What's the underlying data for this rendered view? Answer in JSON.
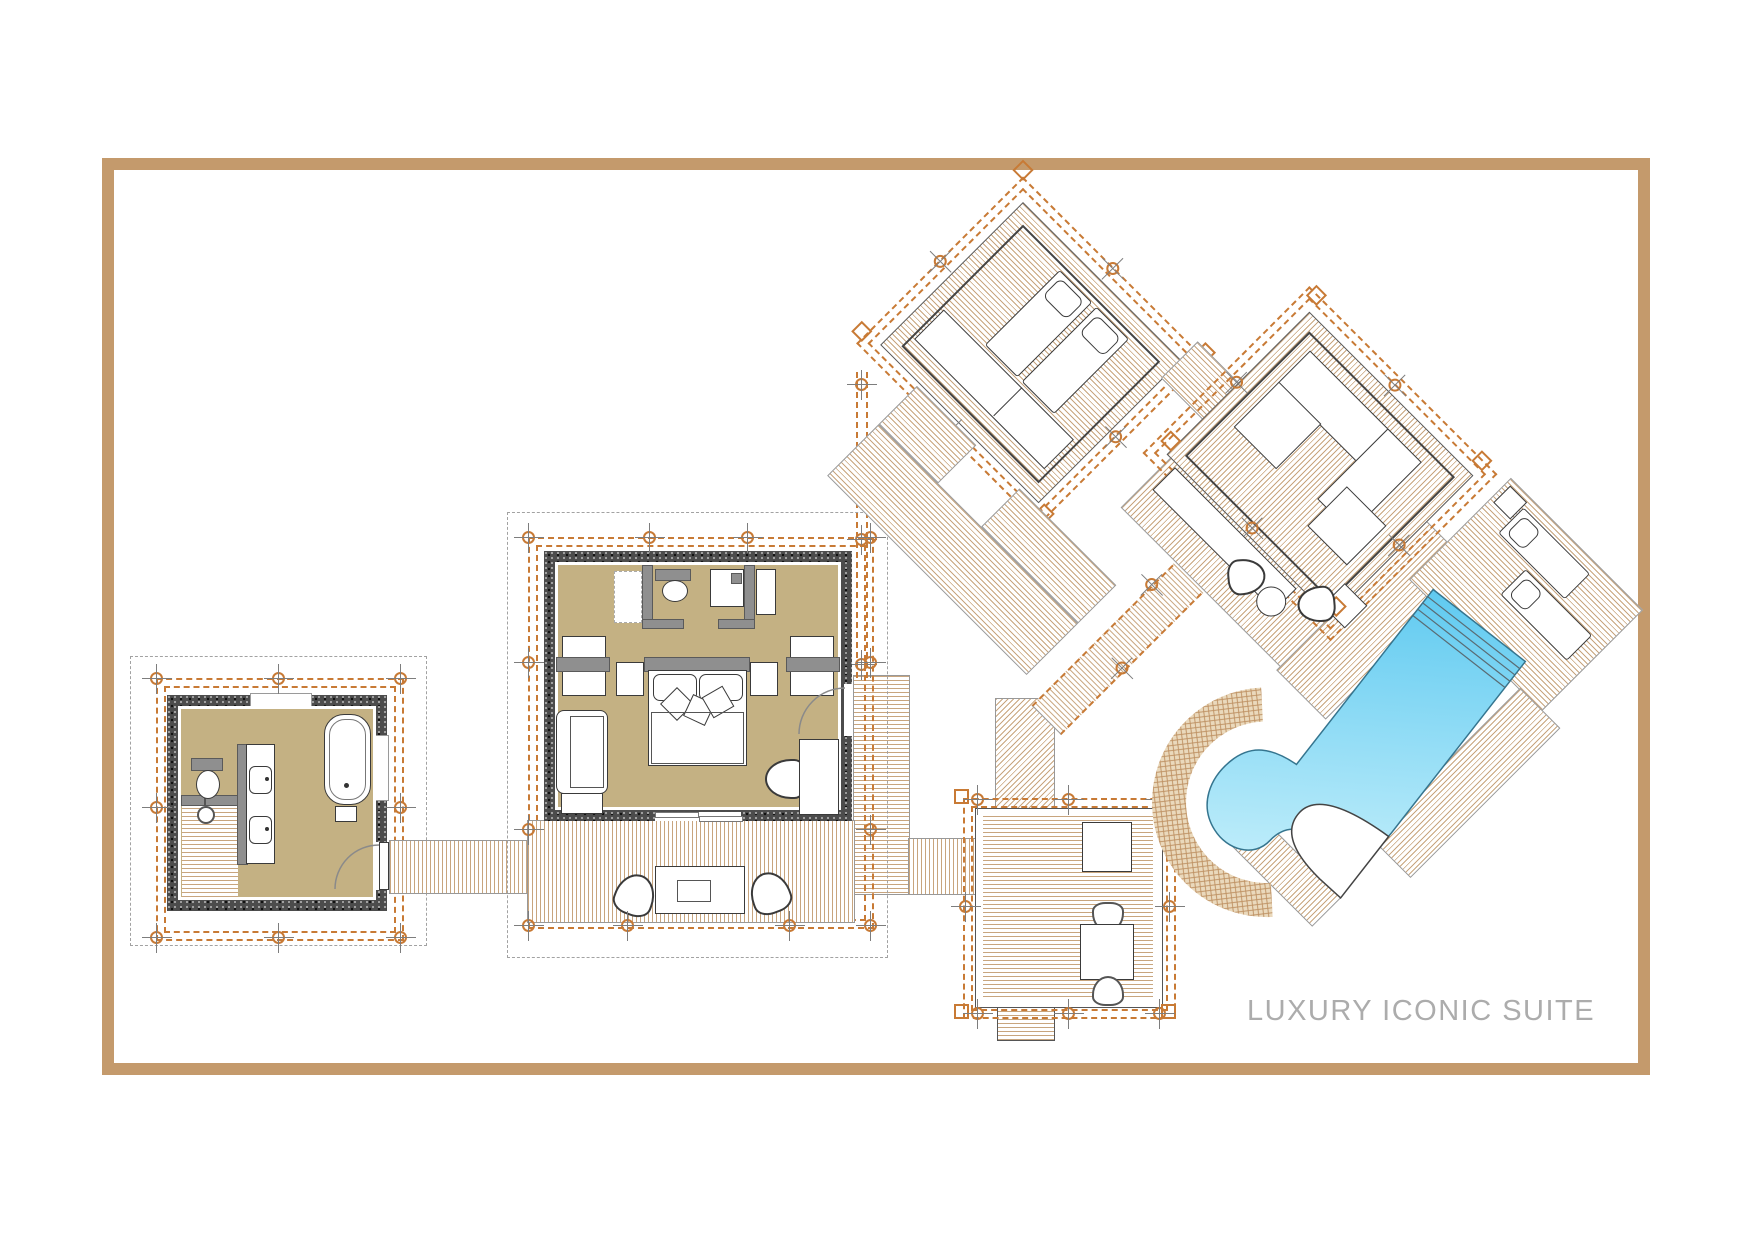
{
  "title": {
    "text": "LUXURY ICONIC SUITE"
  },
  "palette": {
    "frame_tan": "#c49a6c",
    "deck_stripe": "#c8a57e",
    "floor_khaki": "#c4b183",
    "wall_stone": "#4c4c4c",
    "grid_orange": "#c87a35",
    "boundary_gray": "#a2a2a2",
    "pool_blue_dark": "#55c6ef",
    "pool_blue_light": "#bcecfa",
    "title_gray": "#acacac"
  },
  "modules": {
    "bathroom": {
      "label": "bathroom",
      "furniture": [
        "toilet",
        "twin-basin vanity",
        "bathtub",
        "stool",
        "walk-in shower",
        "entry door"
      ]
    },
    "bedroom": {
      "label": "bedroom",
      "furniture": [
        "wc enclosure",
        "vanity basin",
        "double bed with pillows",
        "bedside tables",
        "luggage benches",
        "lounge chair",
        "side table",
        "writing desk",
        "desk chair",
        "entry door",
        "sliding door"
      ]
    },
    "bedroom_terrace": {
      "label": "bedroom terrace",
      "furniture": [
        "coffee table",
        "two armchairs"
      ]
    },
    "dining_deck": {
      "label": "dining deck",
      "furniture": [
        "service table",
        "dining table",
        "two chairs"
      ]
    },
    "sun_pavilion": {
      "label": "rotated sun deck pavilion",
      "furniture": [
        "two sun loungers with pillows",
        "daybed bench"
      ]
    },
    "lounge_pavilion": {
      "label": "rotated lounge pavilion",
      "furniture": [
        "L-shaped sofa",
        "chaise",
        "square coffee table",
        "side table",
        "bench",
        "two deck chairs",
        "round table"
      ]
    },
    "pool": {
      "label": "swimming pool",
      "features": [
        "entry steps",
        "curved hook end",
        "stone surround",
        "peninsula"
      ]
    },
    "pool_deck": {
      "label": "pool deck",
      "furniture": [
        "two sun loungers",
        "side table"
      ]
    }
  }
}
